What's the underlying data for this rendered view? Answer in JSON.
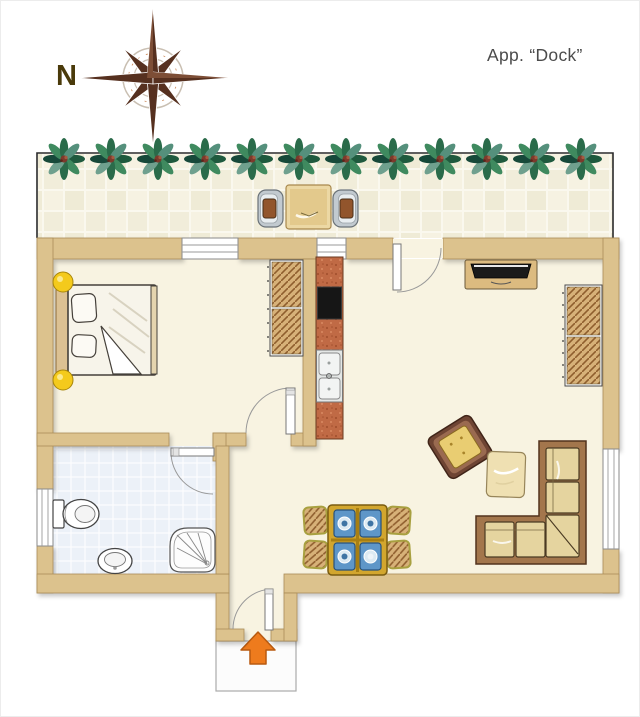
{
  "title": "App. “Dock”",
  "compass": {
    "label": "N",
    "icon": "compass-rose-icon"
  },
  "plan": {
    "type": "apartment-floor-plan",
    "rooms": [
      {
        "id": "terrace",
        "items": [
          "plant-row (12 plants)",
          "bistro-table",
          "terrace-chair-left",
          "terrace-chair-right",
          "tiled-floor"
        ]
      },
      {
        "id": "bedroom",
        "items": [
          "double-bed",
          "bedside-lamp-top",
          "bedside-lamp-bottom",
          "wardrobe",
          "bedroom-window"
        ]
      },
      {
        "id": "kitchenette",
        "items": [
          "counter",
          "cooktop",
          "double-sink",
          "kitchen-window"
        ]
      },
      {
        "id": "living-room",
        "items": [
          "tv-sideboard",
          "shelf-unit",
          "armchair",
          "coffee-table",
          "corner-sofa",
          "dining-table (4 place settings)",
          "dining-chairs (4)",
          "living-room-window",
          "terrace-door"
        ]
      },
      {
        "id": "bathroom",
        "items": [
          "toilet",
          "bidet",
          "corner-shower",
          "bathroom-window",
          "bathroom-door"
        ]
      },
      {
        "id": "entry",
        "items": [
          "entrance-door",
          "porch",
          "entry-direction-arrow"
        ]
      }
    ],
    "doors": [
      "entrance-door",
      "bedroom-door",
      "bathroom-door",
      "terrace-door"
    ],
    "windows": [
      "bedroom-window",
      "kitchen-window",
      "bathroom-window",
      "living-room-window"
    ],
    "counts": {
      "plants": 12,
      "dining_chairs": 4,
      "plates": 4,
      "terrace_chairs": 2
    },
    "colors": {
      "wall": "#dcc28d",
      "floor": "#f8f3e1",
      "bath_tile": "#ecf1f8",
      "terrace_tile": "#f1edda",
      "kitchen_counter": "#c06a45",
      "cooktop": "#161616",
      "arrow_orange": "#ee7b1d",
      "plant_green": "#2a6b4a",
      "sofa_wood": "#a3764c",
      "cushion": "#e5d49f",
      "armchair_yellow": "#e9cd72",
      "dining_table_gold": "#d2a62e",
      "plate_blue": "#5e96c8",
      "lamp_yellow": "#f4ca1c",
      "compass_brown": "#56301f",
      "title_gray": "#4b4b4b"
    }
  }
}
